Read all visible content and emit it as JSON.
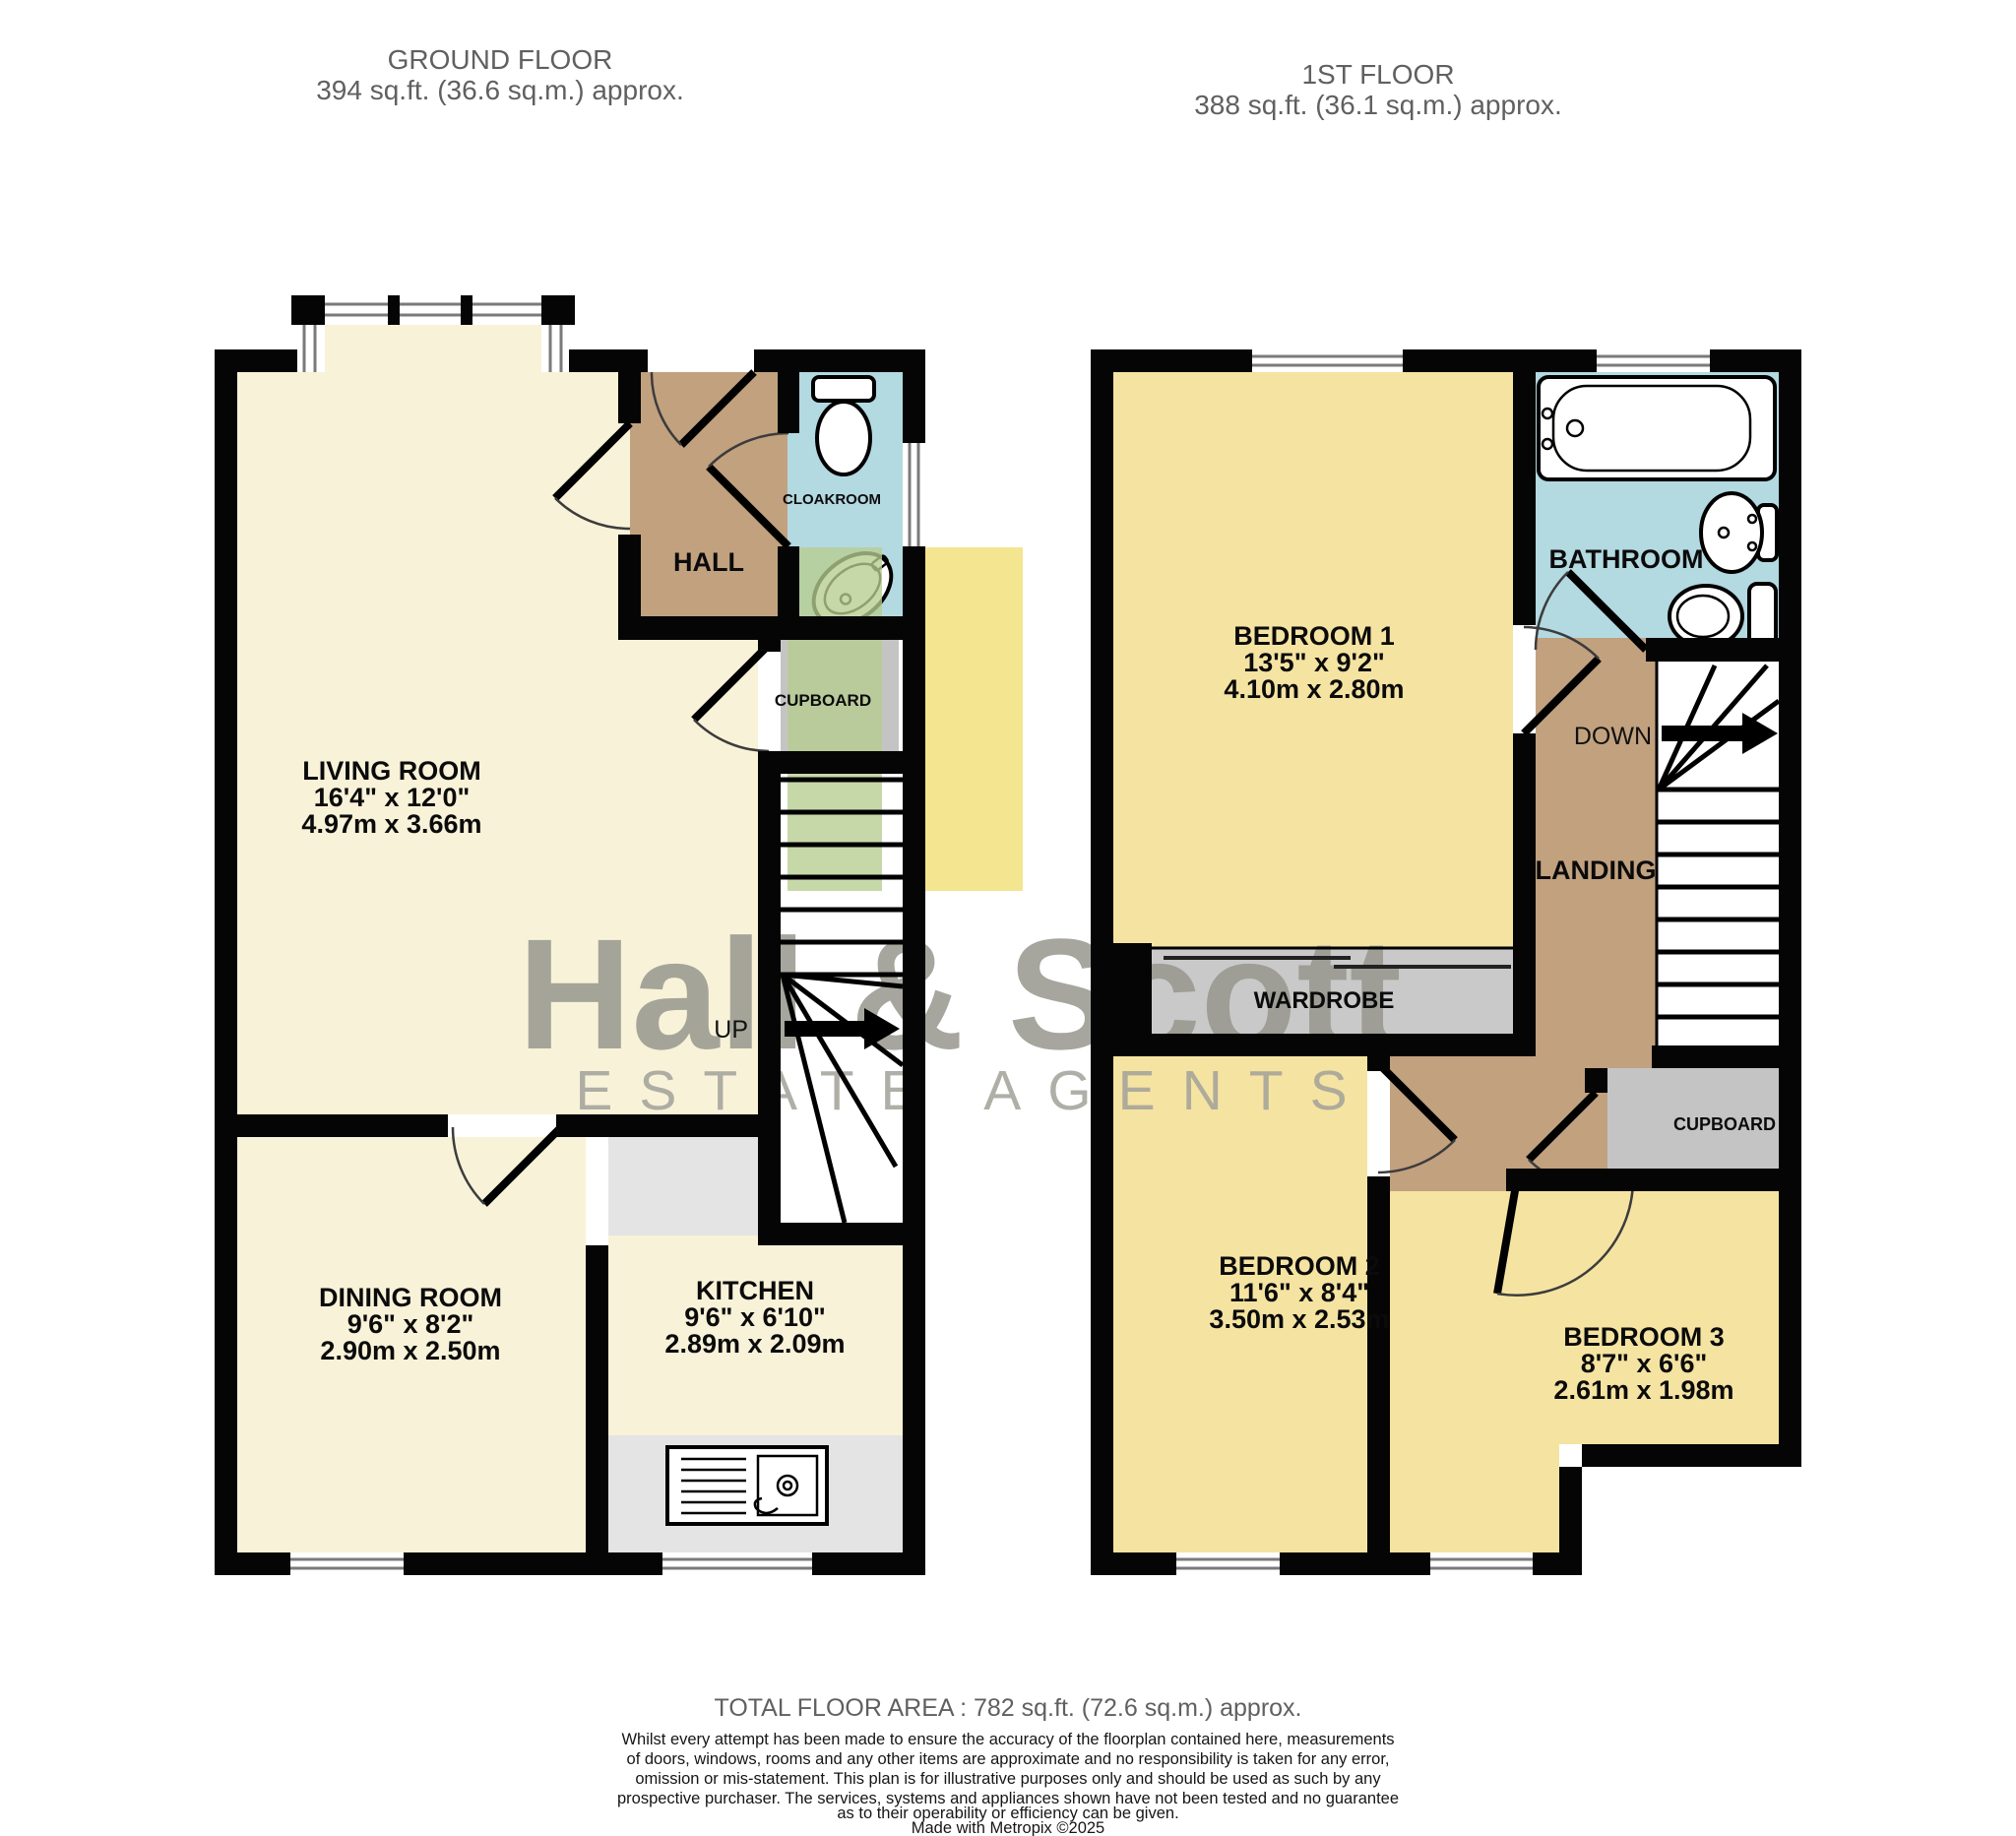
{
  "ground_floor": {
    "title": "GROUND FLOOR",
    "area": "394 sq.ft. (36.6 sq.m.) approx.",
    "stair_direction": "UP",
    "rooms": {
      "living": {
        "name": "LIVING ROOM",
        "imperial": "16'4\" x 12'0\"",
        "metric": "4.97m x 3.66m"
      },
      "hall": {
        "name": "HALL"
      },
      "cloakroom": {
        "name": "CLOAKROOM"
      },
      "cupboard": {
        "name": "CUPBOARD"
      },
      "dining": {
        "name": "DINING ROOM",
        "imperial": "9'6\" x 8'2\"",
        "metric": "2.90m x 2.50m"
      },
      "kitchen": {
        "name": "KITCHEN",
        "imperial": "9'6\" x 6'10\"",
        "metric": "2.89m x 2.09m"
      }
    }
  },
  "first_floor": {
    "title": "1ST FLOOR",
    "area": "388 sq.ft. (36.1 sq.m.) approx.",
    "stair_direction": "DOWN",
    "rooms": {
      "bedroom1": {
        "name": "BEDROOM 1",
        "imperial": "13'5\" x 9'2\"",
        "metric": "4.10m x 2.80m"
      },
      "bathroom": {
        "name": "BATHROOM"
      },
      "landing": {
        "name": "LANDING"
      },
      "wardrobe": {
        "name": "WARDROBE"
      },
      "cupboard": {
        "name": "CUPBOARD"
      },
      "bedroom2": {
        "name": "BEDROOM 2",
        "imperial": "11'6\" x 8'4\"",
        "metric": "3.50m x 2.53m"
      },
      "bedroom3": {
        "name": "BEDROOM 3",
        "imperial": "8'7\" x 6'6\"",
        "metric": "2.61m x 1.98m"
      }
    }
  },
  "watermark": {
    "brand": "Hall & Scott",
    "tagline": "ESTATE AGENTS"
  },
  "footer": {
    "total_area": "TOTAL FLOOR AREA : 782 sq.ft. (72.6 sq.m.) approx.",
    "disclaimer_lines": [
      "Whilst every attempt has been made to ensure the accuracy of the floorplan contained here, measurements",
      "of doors, windows, rooms and any other items are approximate and no responsibility is taken for any error,",
      "omission or mis-statement. This plan is for illustrative purposes only and should be used as such by any",
      "prospective purchaser. The services, systems and appliances shown have not been tested and no guarantee",
      "as to their operability or efficiency can be given."
    ],
    "credit": "Made with Metropix ©2025"
  },
  "colors": {
    "room_cream": "#f8f2d8",
    "bedroom_yellow": "#f5e3a2",
    "hall_tan": "#c2a17f",
    "wet_blue": "#b3d9e1",
    "cupboard_grey": "#c4c4c4",
    "wardrobe_grey": "#c9c9c9",
    "counter_grey": "#e4e4e4",
    "wall_black": "#050505",
    "watermark_green": "#b7cd90",
    "watermark_yellow": "#f1df76",
    "watermark_grey": "#97978e"
  }
}
